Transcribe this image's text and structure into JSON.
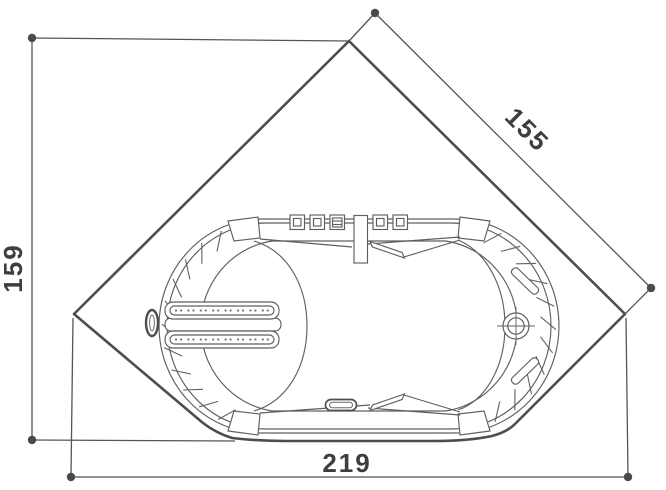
{
  "drawing": {
    "type": "technical-plan-view",
    "subject": "corner-whirlpool-bathtub",
    "dimensions": {
      "diagonal": "155",
      "side": "159",
      "width": "219"
    },
    "colors": {
      "background": "#ffffff",
      "outline": "#4d4d4d",
      "detail": "#5f5f5f",
      "dimension_text": "#3e3e3e"
    },
    "features": [
      "control-buttons",
      "blower-button",
      "faucet-column",
      "faucet-spout",
      "backrest-jet-rails",
      "side-jet-ring",
      "grab-handles",
      "drain",
      "overflow-fitting",
      "rim-ticks"
    ]
  }
}
